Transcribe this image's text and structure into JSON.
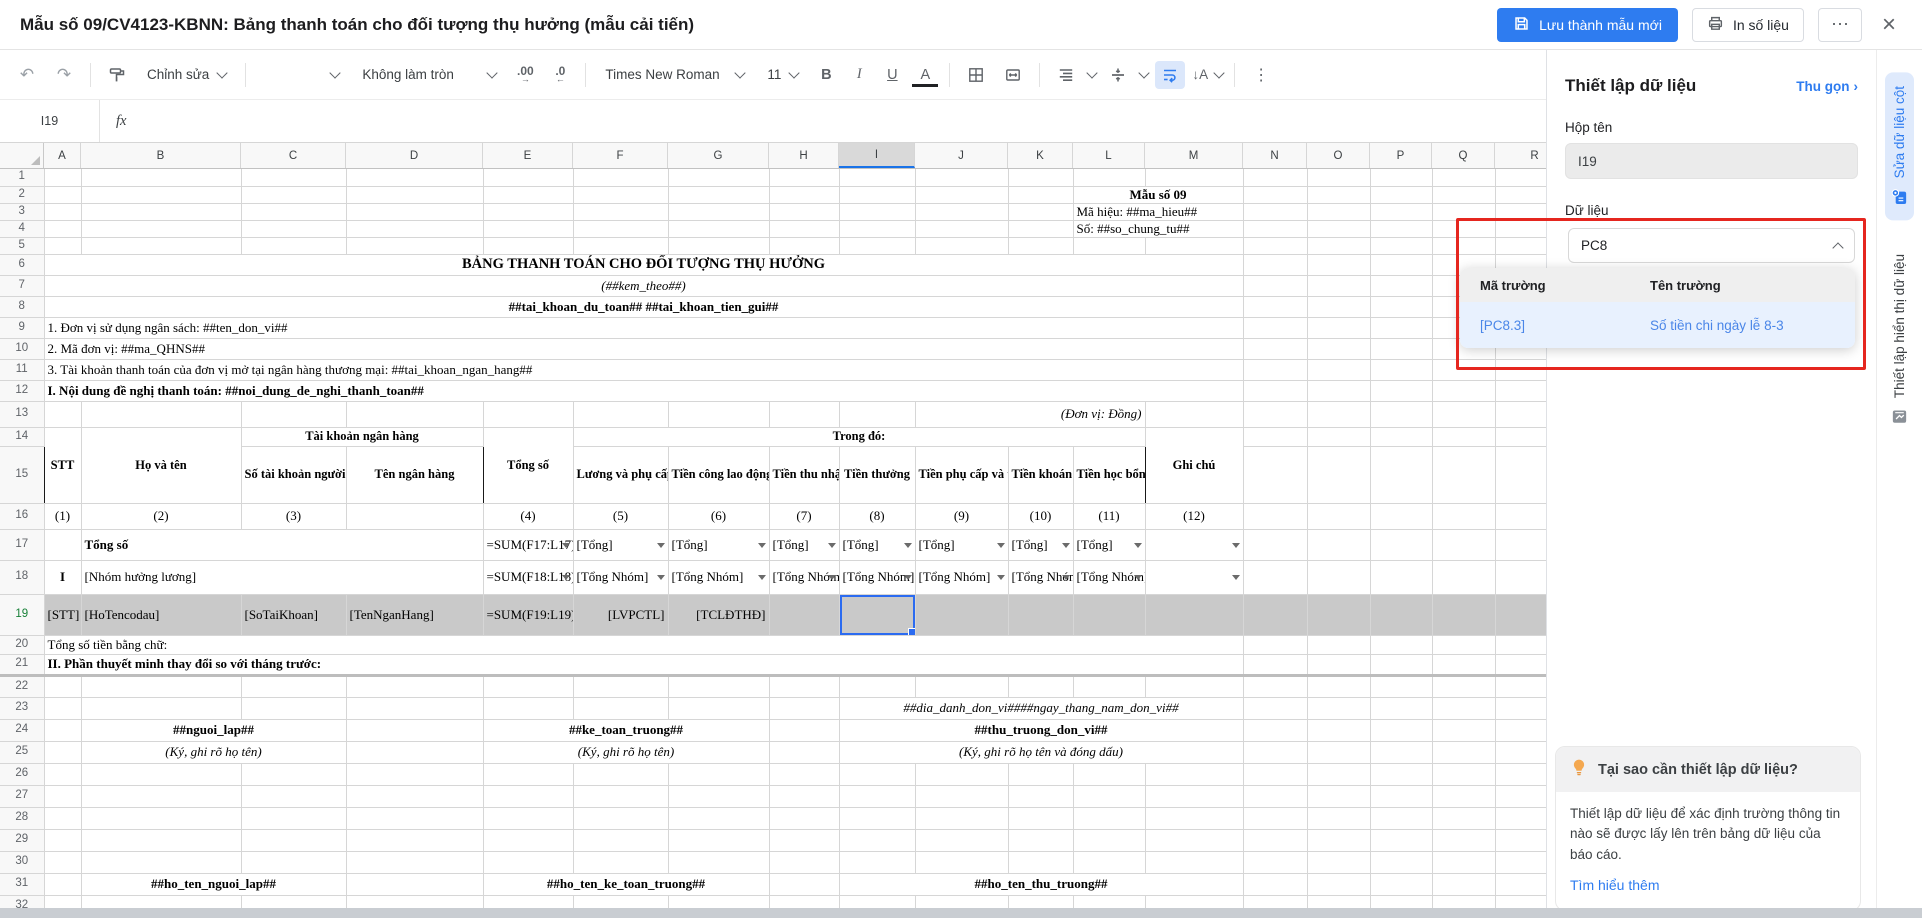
{
  "window": {
    "title": "Mẫu số 09/CV4123-KBNN: Bảng thanh toán cho đối tượng thụ hưởng (mẫu cải tiến)",
    "save_label": "Lưu thành mẫu mới",
    "print_label": "In số liệu",
    "more_glyph": "⋯",
    "close_glyph": "×"
  },
  "colors": {
    "accent_blue": "#2e7cf0",
    "red_annotation": "#e5261f",
    "selected_row_fill": "#c9c9c9",
    "selection_border": "#2b6bf0"
  },
  "toolbar": {
    "undo_glyph": "↶",
    "redo_glyph": "↷",
    "edit_mode": "Chỉnh sửa",
    "rounding": "Không làm tròn",
    "increase_decimal": ".00",
    "decrease_decimal": ".0",
    "arrow_right": "→",
    "arrow_left": "←",
    "font_name": "Times New Roman",
    "font_size": "11",
    "bold": "B",
    "italic": "I",
    "underline": "U",
    "text_color": "A",
    "text_rotation": "↓A",
    "more_glyph": "⋮"
  },
  "formula_bar": {
    "name_box": "I19",
    "fx": "fx"
  },
  "sheet": {
    "columns": [
      "A",
      "B",
      "C",
      "D",
      "E",
      "F",
      "G",
      "H",
      "I",
      "J",
      "K",
      "L",
      "M",
      "N",
      "O",
      "P",
      "Q",
      "R"
    ],
    "col_widths": [
      37,
      160,
      105,
      137,
      90,
      95,
      101,
      70,
      76,
      93,
      65,
      72,
      98,
      64,
      63,
      62,
      63,
      80
    ],
    "selected_column": "I",
    "selected_row": 19,
    "rows": [
      {
        "n": 1,
        "h": 17,
        "cells": []
      },
      {
        "n": 2,
        "h": 17,
        "cells": [
          {
            "c": "L",
            "cs": 2,
            "t": "Mẫu số 09",
            "s": "b c"
          }
        ]
      },
      {
        "n": 3,
        "h": 17,
        "cells": [
          {
            "c": "L",
            "cs": 2,
            "t": "Mã hiệu: ##ma_hieu##",
            "s": ""
          }
        ]
      },
      {
        "n": 4,
        "h": 17,
        "cells": [
          {
            "c": "L",
            "cs": 2,
            "t": "Số: ##so_chung_tu##",
            "s": ""
          }
        ]
      },
      {
        "n": 5,
        "h": 17,
        "cells": []
      },
      {
        "n": 6,
        "h": 21,
        "cells": [
          {
            "c": "A",
            "cs": 13,
            "t": "BẢNG THANH TOÁN CHO ĐỐI TƯỢNG THỤ HƯỞNG",
            "s": "b c big"
          }
        ]
      },
      {
        "n": 7,
        "h": 21,
        "cells": [
          {
            "c": "A",
            "cs": 13,
            "t": "(##kem_theo##)",
            "s": "i c"
          }
        ]
      },
      {
        "n": 8,
        "h": 21,
        "cells": [
          {
            "c": "A",
            "cs": 13,
            "t": "##tai_khoan_du_toan## ##tai_khoan_tien_gui##",
            "s": "b c"
          }
        ]
      },
      {
        "n": 9,
        "h": 21,
        "cells": [
          {
            "c": "A",
            "cs": 13,
            "t": "1. Đơn vị sử dụng ngân sách:  ##ten_don_vi##",
            "s": ""
          }
        ]
      },
      {
        "n": 10,
        "h": 21,
        "cells": [
          {
            "c": "A",
            "cs": 13,
            "t": "2. Mã đơn vị: ##ma_QHNS##",
            "s": ""
          }
        ]
      },
      {
        "n": 11,
        "h": 21,
        "cells": [
          {
            "c": "A",
            "cs": 13,
            "t": "3. Tài khoản thanh toán của đơn vị mở tại ngân hàng thương mại: ##tai_khoan_ngan_hang##",
            "s": ""
          }
        ]
      },
      {
        "n": 12,
        "h": 21,
        "cells": [
          {
            "c": "A",
            "cs": 13,
            "t": "I. Nội dung đề nghị thanh toán: ##noi_dung_de_nghi_thanh_toan##",
            "s": "b"
          }
        ]
      },
      {
        "n": 13,
        "h": 26,
        "cells": [
          {
            "c": "J",
            "cs": 3,
            "t": "(Đơn vị: Đồng)",
            "s": "i r"
          }
        ]
      },
      {
        "n": 14,
        "h": 19,
        "cells": [
          {
            "c": "A",
            "rs": 2,
            "t": "STT",
            "s": "b c m"
          },
          {
            "c": "B",
            "rs": 2,
            "t": "Họ và tên",
            "s": "b c m"
          },
          {
            "c": "C",
            "cs": 2,
            "t": "Tài khoản ngân hàng",
            "s": "b c m"
          },
          {
            "c": "E",
            "rs": 2,
            "t": "Tổng số",
            "s": "b c m"
          },
          {
            "c": "F",
            "cs": 7,
            "t": "Trong đó:",
            "s": "b c m"
          },
          {
            "c": "M",
            "rs": 2,
            "t": "Ghi chú",
            "s": "b c m"
          }
        ]
      },
      {
        "n": 15,
        "h": 57,
        "cells": [
          {
            "c": "C",
            "t": "Số tài khoản người hưởng",
            "s": "b c m"
          },
          {
            "c": "D",
            "t": "Tên ngân hàng",
            "s": "b c m"
          },
          {
            "c": "F",
            "t": "Lương và phụ cấp theo lương",
            "s": "b c m"
          },
          {
            "c": "G",
            "t": "Tiền công lao động theo hợp đồng",
            "s": "b c m"
          },
          {
            "c": "H",
            "t": "Tiền thu nhập tăng thêm",
            "s": "b c m"
          },
          {
            "c": "I",
            "t": "Tiền thưởng",
            "s": "b c m"
          },
          {
            "c": "J",
            "t": "Tiền phụ cấp và trợ cấp khác",
            "s": "b c m"
          },
          {
            "c": "K",
            "t": "Tiền khoán",
            "s": "b c m"
          },
          {
            "c": "L",
            "t": "Tiền học bổng",
            "s": "b c m"
          }
        ]
      },
      {
        "n": 16,
        "h": 26,
        "cells": [
          {
            "c": "A",
            "t": "(1)",
            "s": "c"
          },
          {
            "c": "B",
            "t": "(2)",
            "s": "c"
          },
          {
            "c": "C",
            "t": "(3)",
            "s": "c"
          },
          {
            "c": "E",
            "t": "(4)",
            "s": "c"
          },
          {
            "c": "F",
            "t": "(5)",
            "s": "c"
          },
          {
            "c": "G",
            "t": "(6)",
            "s": "c"
          },
          {
            "c": "H",
            "t": "(7)",
            "s": "c"
          },
          {
            "c": "I",
            "t": "(8)",
            "s": "c"
          },
          {
            "c": "J",
            "t": "(9)",
            "s": "c"
          },
          {
            "c": "K",
            "t": "(10)",
            "s": "c"
          },
          {
            "c": "L",
            "t": "(11)",
            "s": "c"
          },
          {
            "c": "M",
            "t": "(12)",
            "s": "c"
          }
        ]
      },
      {
        "n": 17,
        "h": 31,
        "cells": [
          {
            "c": "B",
            "cs": 3,
            "t": "Tổng số",
            "s": "b"
          },
          {
            "c": "E",
            "t": "=SUM(F17:L17)",
            "s": "ba",
            "dd": 1
          },
          {
            "c": "F",
            "t": "[Tổng]",
            "s": "",
            "dd": 1
          },
          {
            "c": "G",
            "t": "[Tổng]",
            "s": "",
            "dd": 1
          },
          {
            "c": "H",
            "t": "[Tổng]",
            "s": "",
            "dd": 1
          },
          {
            "c": "I",
            "t": "[Tổng]",
            "s": "",
            "dd": 1
          },
          {
            "c": "J",
            "t": "[Tổng]",
            "s": "",
            "dd": 1
          },
          {
            "c": "K",
            "t": "[Tổng]",
            "s": "",
            "dd": 1
          },
          {
            "c": "L",
            "t": "[Tổng]",
            "s": "",
            "dd": 1
          },
          {
            "c": "M",
            "t": "",
            "s": "",
            "dd": 1
          }
        ]
      },
      {
        "n": 18,
        "h": 34,
        "cells": [
          {
            "c": "A",
            "t": "I",
            "s": "b c"
          },
          {
            "c": "B",
            "cs": 3,
            "t": "[Nhóm hưởng lương]",
            "s": ""
          },
          {
            "c": "E",
            "t": "=SUM(F18:L18)",
            "s": "ba",
            "dd": 1
          },
          {
            "c": "F",
            "t": "[Tổng Nhóm]",
            "s": "wr",
            "dd": 1
          },
          {
            "c": "G",
            "t": "[Tổng Nhóm]",
            "s": "wr",
            "dd": 1
          },
          {
            "c": "H",
            "t": "[Tổng Nhóm]",
            "s": "wr",
            "dd": 1
          },
          {
            "c": "I",
            "t": "[Tổng Nhóm]",
            "s": "wr",
            "dd": 1
          },
          {
            "c": "J",
            "t": "[Tổng Nhóm]",
            "s": "wr",
            "dd": 1
          },
          {
            "c": "K",
            "t": "[Tổng Nhóm]",
            "s": "wr",
            "dd": 1
          },
          {
            "c": "L",
            "t": "[Tổng Nhóm]",
            "s": "wr",
            "dd": 1
          },
          {
            "c": "M",
            "t": "",
            "s": "",
            "dd": 1
          }
        ]
      },
      {
        "n": 19,
        "h": 41,
        "fill": true,
        "cells": [
          {
            "c": "A",
            "t": "[STT]",
            "s": ""
          },
          {
            "c": "B",
            "t": "[HoTencodau]",
            "s": ""
          },
          {
            "c": "C",
            "t": "[SoTaiKhoan]",
            "s": ""
          },
          {
            "c": "D",
            "t": "[TenNganHang]",
            "s": ""
          },
          {
            "c": "E",
            "t": "=SUM(F19:L19)",
            "s": "ba r"
          },
          {
            "c": "F",
            "t": "[LVPCTL]",
            "s": "r"
          },
          {
            "c": "G",
            "t": "[TCLĐTHĐ]",
            "s": "r"
          },
          {
            "c": "I",
            "t": "",
            "s": "sel"
          }
        ]
      },
      {
        "n": 20,
        "h": 19,
        "cells": [
          {
            "c": "A",
            "cs": 13,
            "t": "Tổng số tiền bằng chữ:",
            "s": "box20"
          }
        ]
      },
      {
        "n": 21,
        "h": 21,
        "cls": "pb",
        "cells": [
          {
            "c": "A",
            "cs": 13,
            "t": "II. Phần thuyết minh thay đổi so với tháng trước:",
            "s": "b"
          }
        ]
      },
      {
        "n": 22,
        "h": 22,
        "cells": []
      },
      {
        "n": 23,
        "h": 22,
        "cells": [
          {
            "c": "I",
            "cs": 5,
            "t": "##dia_danh_don_vi####ngay_thang_nam_don_vi##",
            "s": "i c"
          }
        ]
      },
      {
        "n": 24,
        "h": 22,
        "cells": [
          {
            "c": "B",
            "cs": 2,
            "t": "##nguoi_lap##",
            "s": "b c"
          },
          {
            "c": "E",
            "cs": 3,
            "t": "##ke_toan_truong##",
            "s": "b c"
          },
          {
            "c": "I",
            "cs": 5,
            "t": "##thu_truong_don_vi##",
            "s": "b c"
          }
        ]
      },
      {
        "n": 25,
        "h": 22,
        "cells": [
          {
            "c": "B",
            "cs": 2,
            "t": "(Ký, ghi rõ họ tên)",
            "s": "i c"
          },
          {
            "c": "E",
            "cs": 3,
            "t": "(Ký, ghi rõ họ tên)",
            "s": "i c"
          },
          {
            "c": "I",
            "cs": 5,
            "t": "(Ký, ghi rõ họ tên và đóng dấu)",
            "s": "i c"
          }
        ]
      },
      {
        "n": 26,
        "h": 22,
        "cells": []
      },
      {
        "n": 27,
        "h": 22,
        "cells": []
      },
      {
        "n": 28,
        "h": 22,
        "cells": []
      },
      {
        "n": 29,
        "h": 22,
        "cells": []
      },
      {
        "n": 30,
        "h": 22,
        "cells": []
      },
      {
        "n": 31,
        "h": 22,
        "cells": [
          {
            "c": "B",
            "cs": 2,
            "t": "##ho_ten_nguoi_lap##",
            "s": "b c"
          },
          {
            "c": "E",
            "cs": 3,
            "t": "##ho_ten_ke_toan_truong##",
            "s": "b c"
          },
          {
            "c": "I",
            "cs": 5,
            "t": "##ho_ten_thu_truong##",
            "s": "b c"
          }
        ]
      },
      {
        "n": 32,
        "h": 22,
        "cells": []
      },
      {
        "n": 33,
        "h": 22,
        "cells": []
      }
    ]
  },
  "panel": {
    "title": "Thiết lập dữ liệu",
    "collapse_label": "Thu gọn",
    "collapse_glyph": "›",
    "name_box_label": "Hộp tên",
    "name_box_value": "I19",
    "data_label": "Dữ liệu",
    "data_value": "PC8",
    "dropdown": {
      "col_code": "Mã trường",
      "col_name": "Tên trường",
      "rows": [
        {
          "code": "[PC8.3]",
          "name": "Số tiền chi ngày lễ 8-3"
        }
      ]
    },
    "hint": {
      "title": "Tại sao cần thiết lập dữ liệu?",
      "body": "Thiết lập dữ liệu để xác định trường thông tin nào sẽ được lấy lên trên bảng dữ liệu của báo cáo.",
      "link": "Tìm hiểu thêm"
    }
  },
  "rail": {
    "tabs": [
      {
        "label": "Sửa dữ liệu cột",
        "active": true
      },
      {
        "label": "Thiết lập hiển thị dữ liệu",
        "active": false
      }
    ]
  }
}
